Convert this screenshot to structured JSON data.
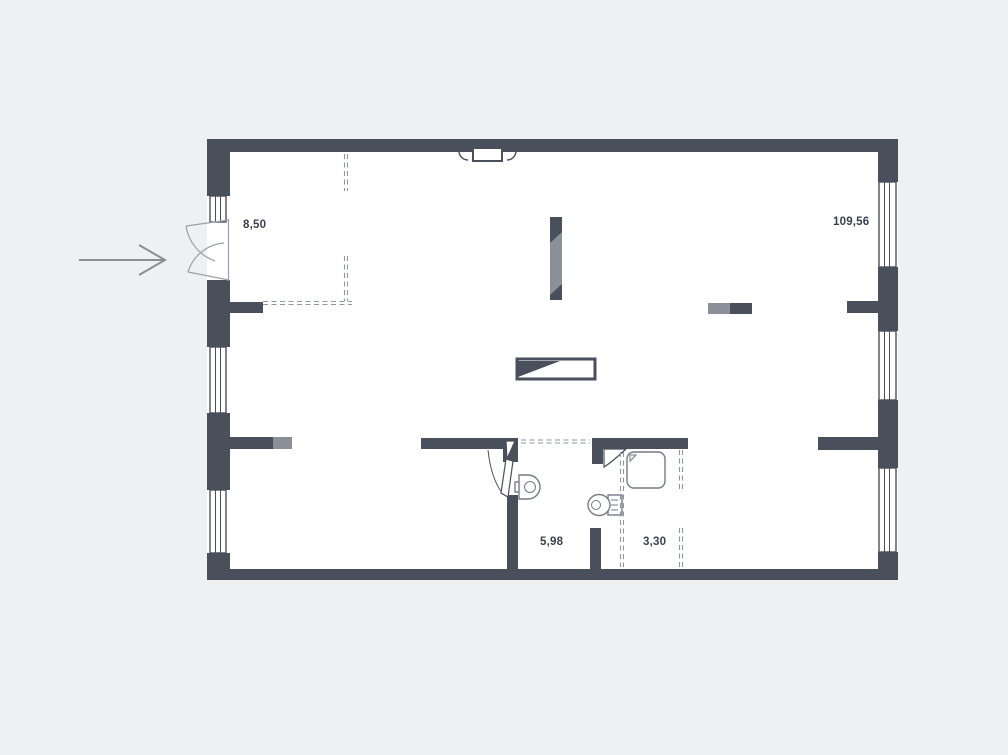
{
  "title": "Apartment floor plan",
  "colors": {
    "background": "#eff0f2",
    "floor": "#ffffff",
    "wall": "#4a4f5c",
    "wall_light": "#8a8f99",
    "fixture_outline": "#757a85",
    "dash": "#8f95a0",
    "door_arc": "#9ba1aa",
    "label": "#3b404d",
    "arrow": "#8b8e95"
  },
  "rooms": {
    "entry": {
      "name": "entry-zone",
      "area_label": "8,50"
    },
    "main": {
      "name": "main-space",
      "area_label": "109,56"
    },
    "bathroom": {
      "name": "bathroom",
      "area_label": "5,98"
    },
    "wc": {
      "name": "wc",
      "area_label": "3,30"
    }
  }
}
